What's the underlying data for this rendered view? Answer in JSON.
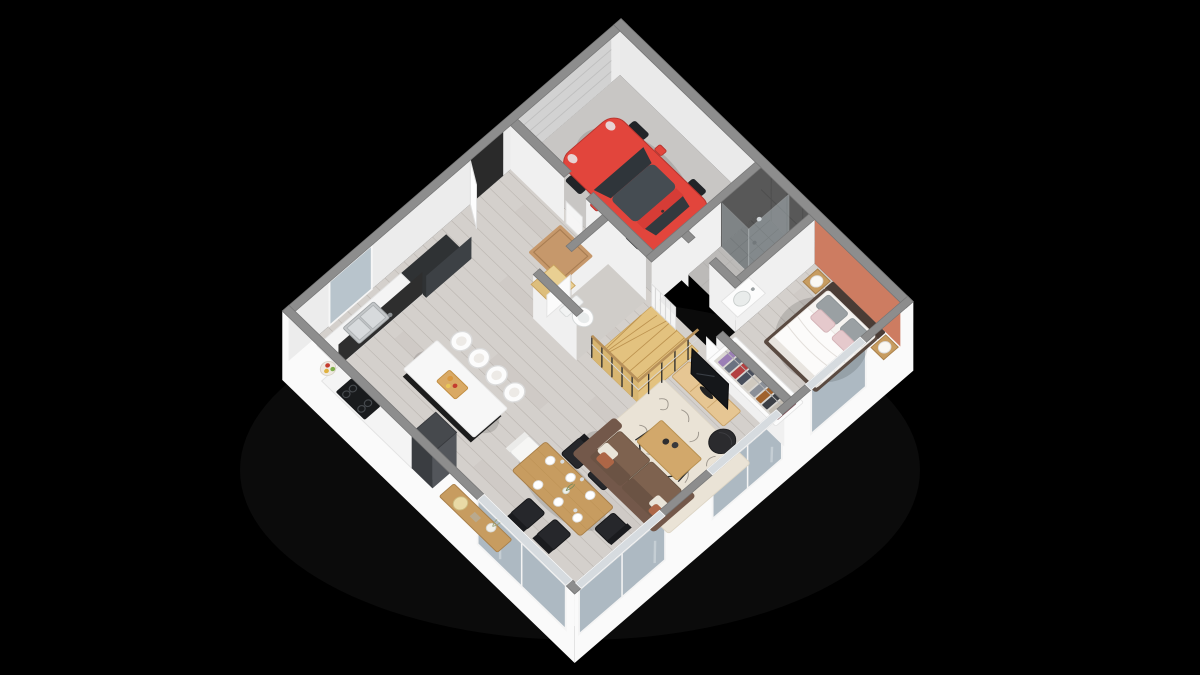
{
  "scene": {
    "type": "3d-floor-plan-render",
    "view": "isometric-top-down",
    "level": "ground-floor",
    "background_label": "black"
  },
  "colors": {
    "background": "#000000",
    "wall_top": "#8d8d8d",
    "wall_face": "#f0f0f0",
    "exterior_face": "#fafafa",
    "accent_wall": "#cd7c61",
    "wood_floor": "#d4d0cc",
    "plank_line": "#a8a29c",
    "garage_floor": "#c8c6c4",
    "tile_floor": "#bcbab8",
    "shower_tile": "#585858",
    "glass": "#adb9c2",
    "car_red": "#e2453c",
    "car_glass": "#454c52",
    "stair_wood": "#e3c27f",
    "rail_wood": "#b8915a",
    "rug": "#eae3d6",
    "sofa": "#73584a",
    "sofa_seat": "#7e624f",
    "table_wood": "#c79c60",
    "island_top": "#f7f7f7",
    "island_base": "#1c1c1c",
    "counter_dark": "#2e2e2e",
    "counter_top": "#f4f4f4",
    "fridge": "#46494d",
    "doormat": "#c6986b",
    "bed_frame": "#4a3c35",
    "bedding": "#f6f4f1",
    "pillow_gray": "#9aa0a3",
    "pillow_pink": "#e5c9cc",
    "tv_black": "#15171a",
    "garage_door": "#d2d2d2"
  },
  "palette": {
    "clothes": [
      "#9b7fb6",
      "#6b7280",
      "#b34040",
      "#494f5c",
      "#cfc9bf",
      "#8a8f98",
      "#a0622d",
      "#3c3f45",
      "#c2bcb2",
      "#7c4a52"
    ]
  },
  "rooms": [
    {
      "name": "garage",
      "furniture": [
        "red hatchback car",
        "sectional garage door"
      ]
    },
    {
      "name": "bathroom",
      "furniture": [
        "walk-in tiled shower",
        "vanity with basin"
      ]
    },
    {
      "name": "bedroom",
      "furniture": [
        "double bed",
        "two wooden nightstands with white lamps",
        "open wardrobe with hanging clothes",
        "terracotta accent wall"
      ]
    },
    {
      "name": "living-room",
      "furniture": [
        "brown three-seat sofa",
        "wooden coffee table with cups",
        "cream patterned rug",
        "TV on low wooden board",
        "black round pouf"
      ]
    },
    {
      "name": "kitchen",
      "furniture": [
        "counter with double sink",
        "black cooktop",
        "tall dark fridge",
        "black island with white top",
        "four white bar stools",
        "cutting board with food",
        "fruit bowl"
      ]
    },
    {
      "name": "dining-area",
      "furniture": [
        "wooden dining table set with plates",
        "five black metal chairs",
        "one white chair",
        "sideboard with lamp and vase"
      ]
    },
    {
      "name": "hall",
      "furniture": [
        "open front door",
        "doormat",
        "entry steps"
      ]
    },
    {
      "name": "wc",
      "furniture": [
        "toilet"
      ]
    },
    {
      "name": "staircase",
      "furniture": [
        "quarter-turn wooden stairs",
        "black posts railing",
        "white slat guard"
      ]
    }
  ]
}
